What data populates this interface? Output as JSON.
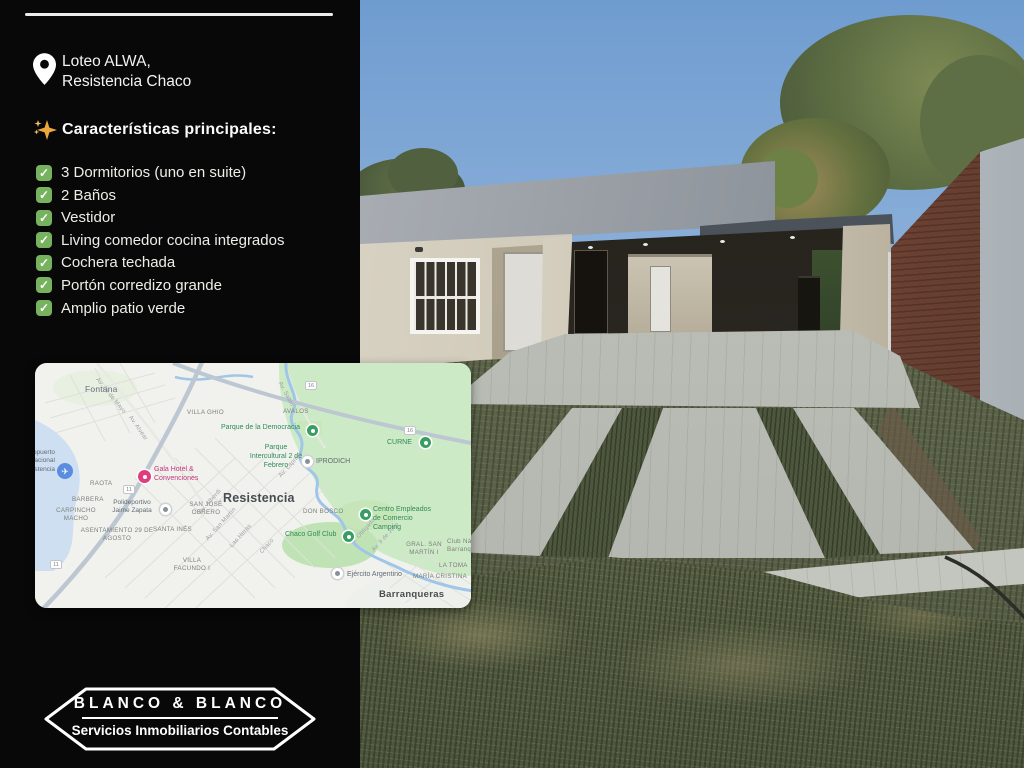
{
  "panel": {
    "location": {
      "line1": "Loteo ALWA,",
      "line2": "Resistencia Chaco"
    },
    "features": {
      "title": "Características principales:",
      "items": [
        "3 Dormitorios (uno en suite)",
        "2 Baños",
        "Vestidor",
        "Living comedor cocina integrados",
        "Cochera techada",
        "Portón corredizo grande",
        "Amplio patio verde"
      ]
    },
    "logo": {
      "name": "BLANCO & BLANCO",
      "tagline": "Servicios Inmobiliarios Contables"
    }
  },
  "map": {
    "labels": {
      "fontana": "Fontana",
      "av_25_mayo": "Av. 25 de Mayo",
      "av_alvear": "Av. Alvear",
      "av_sabin": "Av. Sabin",
      "villa_ghio": "VILLA GHIO",
      "avalos": "AVALOS",
      "parque_democracia": "Parque de la Democracia",
      "parque_intercultural": "Parque Intercultural 2 de Febrero",
      "curne": "CURNE",
      "iprodich": "IPRODICH",
      "gala": "Gala Hotel & Convenciones",
      "aeropuerto": "Aeropuerto Internacional Resistencia",
      "raota": "RAOTA",
      "barbera": "BARBERA",
      "carpincho": "CARPINCHO MACHO",
      "asentamiento": "ASENTAMIENTO 29 DE AGOSTO",
      "polideportivo": "Polideportivo Jaime Zapata",
      "san_jose": "SAN JOSÉ OBRERO",
      "santa_ines": "SANTA INÉS",
      "villa_facundo": "VILLA FACUNDO I",
      "resistencia": "Resistencia",
      "av_laprida": "Av. Laprida",
      "av_alberdi": "Av. Alberdi",
      "av_san_martin": "Av. San Martín",
      "las_heras": "Las Heras",
      "obligado": "V. Obligado",
      "chaco_st": "Chaco",
      "av_9_julio": "Av. 9 de Julio",
      "don_bosco": "DON BOSCO",
      "golf": "Chaco Golf Club",
      "camping": "Centro Empleados de Comercio Camping",
      "gral_san_martin": "GRAL. SAN MARTÍN I",
      "club_nautico": "Club Náutico Barranqueras",
      "la_toma": "LA TOMA",
      "maria_cristina": "MARÍA CRISTINA",
      "ejercito": "Ejército Argentino",
      "barranqueras": "Barranqueras"
    },
    "shields": {
      "r11": "11",
      "r16": "16"
    }
  },
  "colors": {
    "check_green": "#77b25f",
    "sparkle_gold": "#eda83d",
    "poi_pink": "#df3d7d",
    "poi_green": "#3a9e63",
    "panel_black": "#080808"
  }
}
